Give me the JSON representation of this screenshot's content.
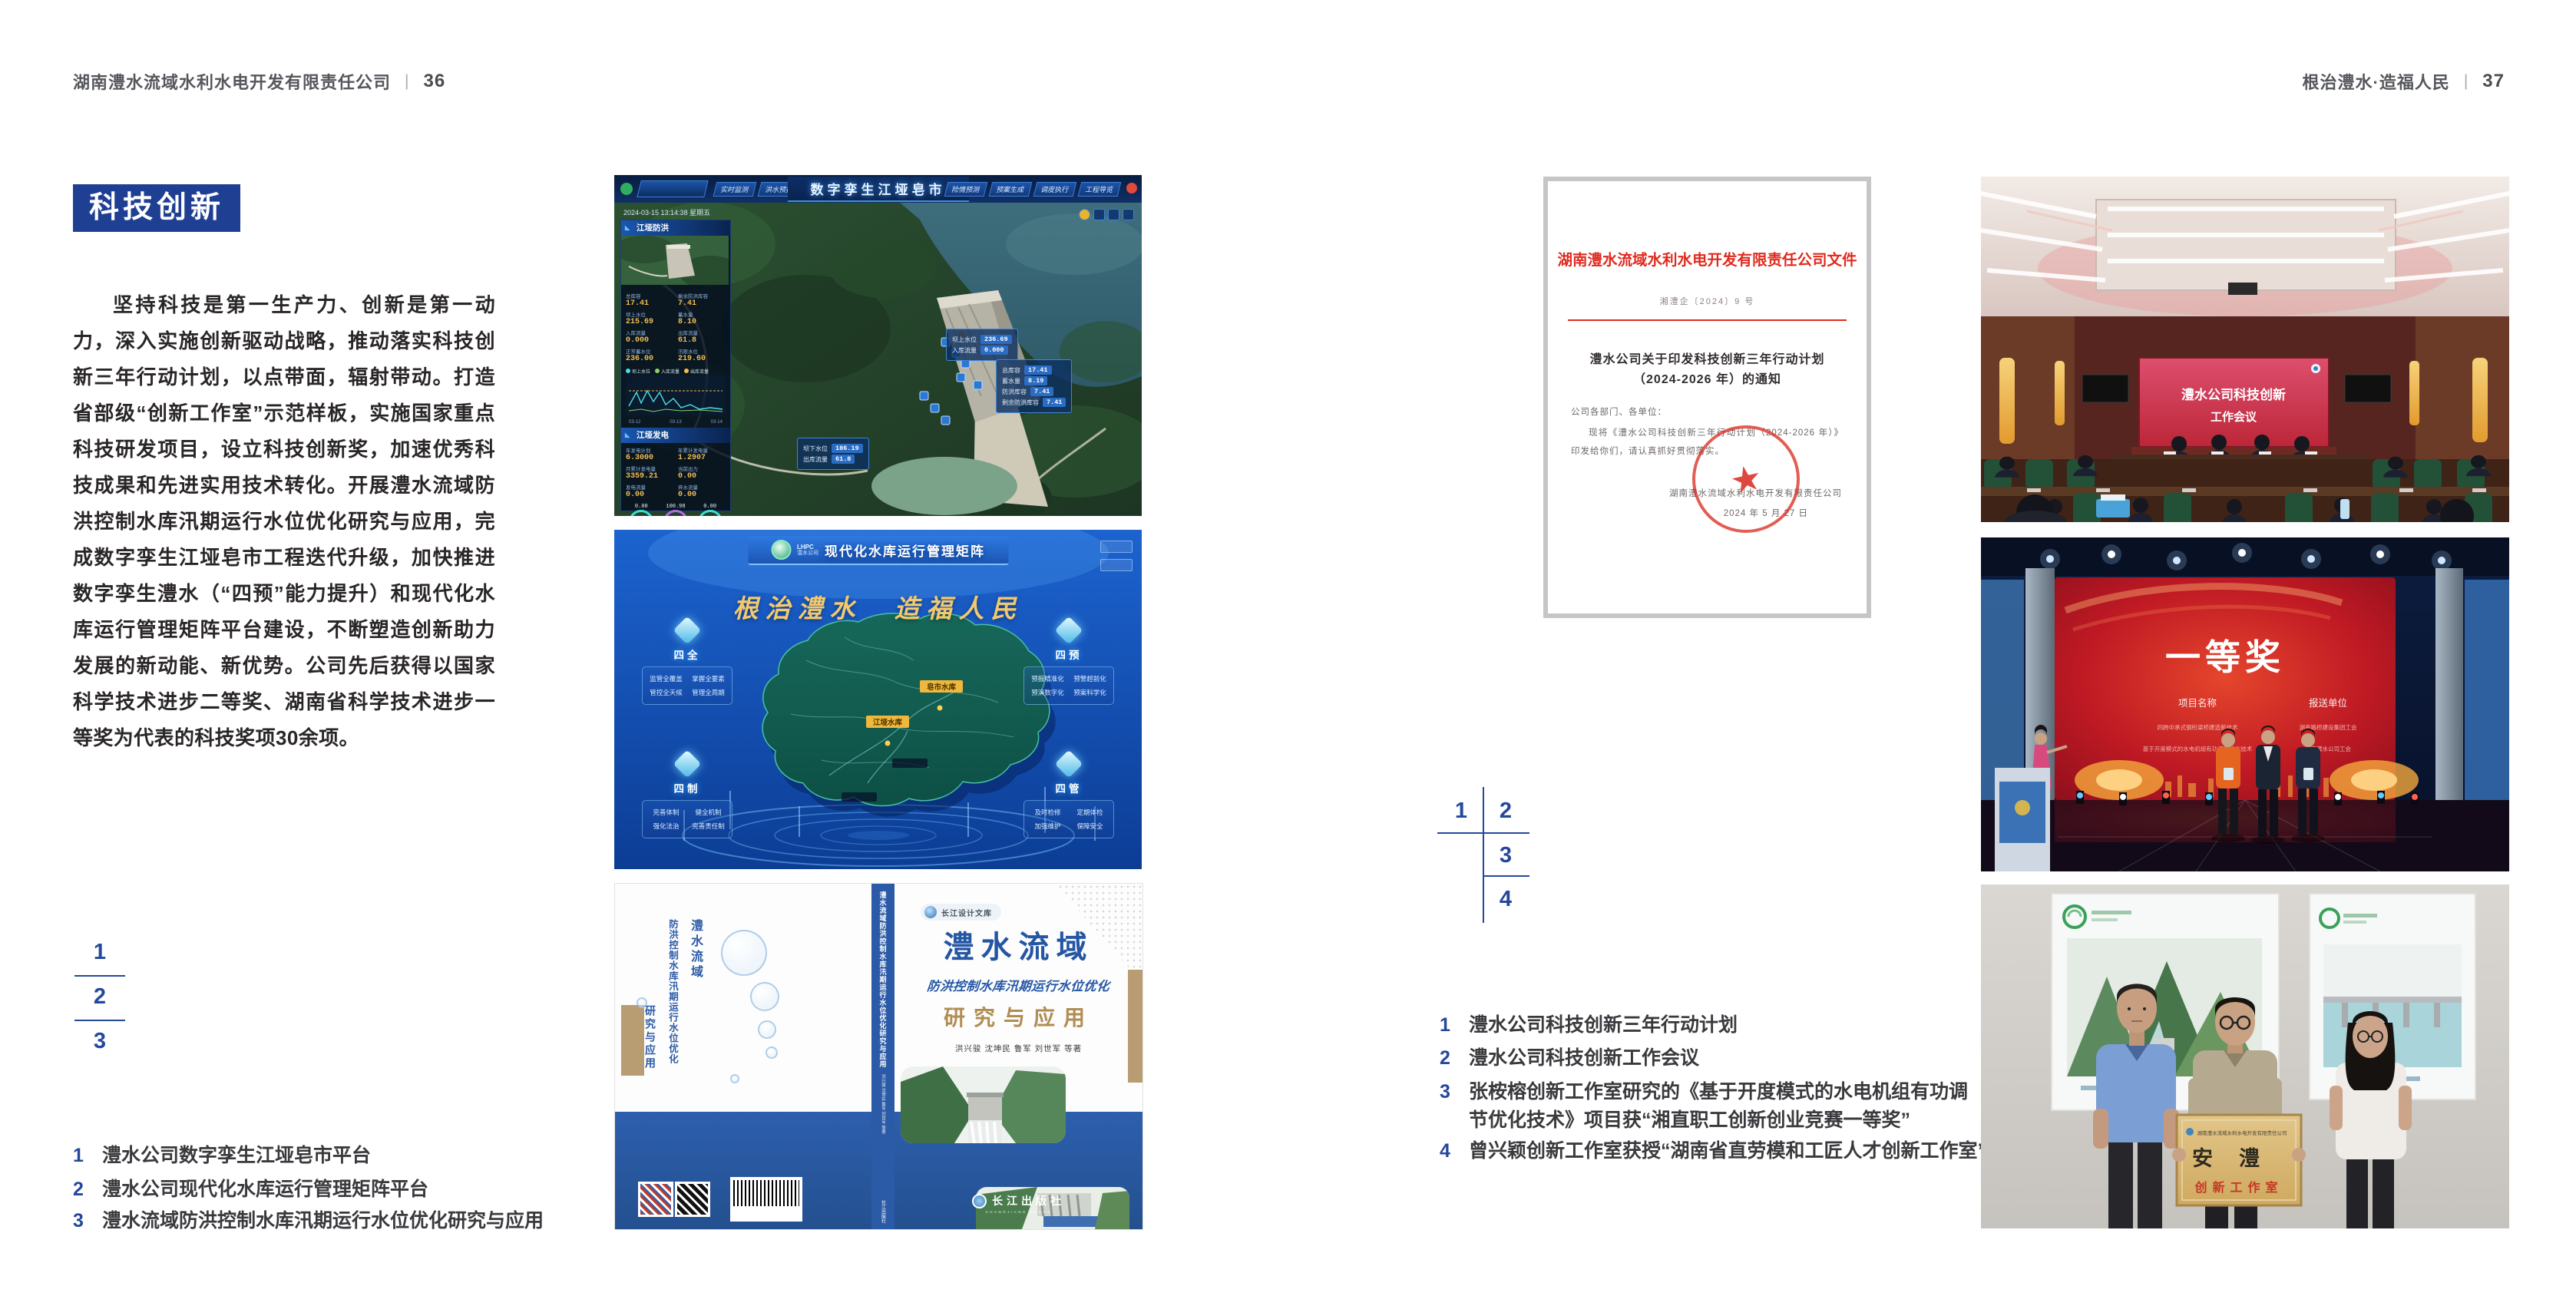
{
  "colors": {
    "accent_blue": "#1e3f92",
    "caption_blue": "#24489a",
    "text_dark": "#2a2628",
    "header_gray": "#55575c",
    "doc_red": "#d92d20",
    "book_blue": "#2b5aa7",
    "gold": "#b08d53"
  },
  "left_page": {
    "header_company": "湖南澧水流域水利水电开发有限责任公司",
    "header_sep": "|",
    "page_number": "36",
    "section_title": "科技创新",
    "paragraph": "坚持科技是第一生产力、创新是第一动力，深入实施创新驱动战略，推动落实科技创新三年行动计划，以点带面，辐射带动。打造省部级“创新工作室”示范样板，实施国家重点科技研发项目，设立科技创新奖，加速优秀科技成果和先进实用技术转化。开展澧水流域防洪控制水库汛期运行水位优化研究与应用，完成数字孪生江垭皂市工程迭代升级，加快推进数字孪生澧水（“四预”能力提升）和现代化水库运行管理矩阵平台建设，不断塑造创新助力发展的新动能、新优势。公司先后获得以国家科学技术进步二等奖、湖南省科学技术进步一等奖为代表的科技奖项30余项。",
    "figure_numbers": [
      "1",
      "2",
      "3"
    ],
    "captions": [
      {
        "num": "1",
        "text": "澧水公司数字孪生江垭皂市平台"
      },
      {
        "num": "2",
        "text": "澧水公司现代化水库运行管理矩阵平台"
      },
      {
        "num": "3",
        "text": "澧水流域防洪控制水库汛期运行水位优化研究与应用"
      }
    ]
  },
  "right_page": {
    "header_slogan": "根治澧水·造福人民",
    "header_sep": "|",
    "page_number": "37",
    "figure_numbers": [
      "1",
      "2",
      "3",
      "4"
    ],
    "captions": [
      {
        "num": "1",
        "text": "澧水公司科技创新三年行动计划"
      },
      {
        "num": "2",
        "text": "澧水公司科技创新工作会议"
      },
      {
        "num": "3",
        "text": "张桉榕创新工作室研究的《基于开度模式的水电机组有功调节优化技术》项目获“湘直职工创新创业竞赛一等奖”"
      },
      {
        "num": "4",
        "text": "曾兴颖创新工作室获授“湖南省直劳模和工匠人才创新工作室”"
      }
    ]
  },
  "fig_twin": {
    "title": "数字孪生江垭皂市",
    "datetime": "2024-03-15 13:14:38 星期五",
    "tabs_left": [
      "实时监测",
      "洪水预报",
      "防洪预警"
    ],
    "tabs_right": [
      "险情预测",
      "预案生成",
      "调度执行",
      "工程导览"
    ],
    "panel1_title": "江垭防洪",
    "panel2_title": "江垭发电",
    "stats1": [
      {
        "label": "总库容",
        "value": "17.41"
      },
      {
        "label": "剩余防洪库容",
        "value": "7.41"
      },
      {
        "label": "坝上水位",
        "value": "215.69"
      },
      {
        "label": "蓄水量",
        "value": "8.10"
      },
      {
        "label": "入库流量",
        "value": "0.000"
      },
      {
        "label": "出库流量",
        "value": "61.8"
      },
      {
        "label": "正常蓄水位",
        "value": "236.00"
      },
      {
        "label": "汛限水位",
        "value": "219.60"
      }
    ],
    "stats2": [
      {
        "label": "年发电计划",
        "value": "6.3000"
      },
      {
        "label": "年累计发电量",
        "value": "1.2907"
      },
      {
        "label": "月累计发电量",
        "value": "3359.21"
      },
      {
        "label": "当前出力",
        "value": "0.00"
      },
      {
        "label": "发电流量",
        "value": "0.00"
      },
      {
        "label": "弃水流量",
        "value": "0.00"
      }
    ],
    "gauge_values": [
      "0.00",
      "100.98",
      "0.00"
    ],
    "chart_legend": [
      "坝上水位",
      "入库流量",
      "出库流量"
    ],
    "chart_ticks": [
      "03-12",
      "03-13",
      "03-14"
    ],
    "box1": [
      {
        "label": "坝上水位",
        "value": "236.69"
      },
      {
        "label": "入库流量",
        "value": "0.000"
      }
    ],
    "box2": [
      {
        "label": "总库容",
        "value": "17.41"
      },
      {
        "label": "蓄水量",
        "value": "8.19"
      },
      {
        "label": "防洪库容",
        "value": "7.41"
      },
      {
        "label": "剩余防洪库容",
        "value": "7.41"
      }
    ],
    "box3": [
      {
        "label": "坝下水位",
        "value": "186.19"
      },
      {
        "label": "出库流量",
        "value": "61.8"
      }
    ]
  },
  "fig_matrix": {
    "logo_abbr": "LHPC",
    "logo_name": "澧水公司",
    "title": "现代化水库运行管理矩阵",
    "slogan": "根治澧水　造福人民",
    "panels": [
      {
        "title": "四全",
        "items": [
          "监管全覆盖",
          "掌握全要素",
          "管控全天候",
          "管理全周期"
        ]
      },
      {
        "title": "四预",
        "items": [
          "预报精准化",
          "预警超前化",
          "预演数字化",
          "预案科学化"
        ]
      },
      {
        "title": "四制",
        "items": [
          "完善体制",
          "健全机制",
          "强化法治",
          "完善责任制"
        ]
      },
      {
        "title": "四管",
        "items": [
          "及时检修",
          "定期体检",
          "加强维护",
          "保障安全"
        ]
      }
    ],
    "map_tags": [
      "皂市水库",
      "江垭水库"
    ]
  },
  "fig_book": {
    "series": "长江设计文库",
    "title_main": "澧水流域",
    "title_sub": "防洪控制水库汛期运行水位优化",
    "title_tail": "研究与应用",
    "authors": "洪兴骏 沈坤民 鲁军 刘世军 等著",
    "publisher": "长江出版社",
    "publisher_latin": "CHANGJIANG PRESS",
    "spine": "澧水流域防洪控制水库汛期运行水位优化研究与应用"
  },
  "fig_doc": {
    "header": "湖南澧水流域水利水电开发有限责任公司文件",
    "doc_no": "湘澧企〔2024〕9 号",
    "title1": "澧水公司关于印发科技创新三年行动计划",
    "title2": "（2024-2026 年）的通知",
    "salutation": "公司各部门、各单位：",
    "body": "现将《澧水公司科技创新三年行动计划（2024-2026 年）》印发给你们，请认真抓好贯彻落实。",
    "signer": "湖南澧水流域水利水电开发有限责任公司",
    "sign_date": "2024 年 5 月 27 日"
  },
  "fig_meeting": {
    "screen1": "澧水公司科技创新",
    "screen2": "工作会议"
  },
  "fig_award": {
    "title": "一等奖",
    "col1": "项目名称",
    "col2": "报送单位",
    "projects": [
      "四跨中承式钢桁梁桥建造新技术",
      "基于开度模式的水电机组有功调节优化技术"
    ],
    "units": [
      "湖南路桥建设集团工会",
      "湖南澧水公司工会"
    ]
  },
  "fig_workshop": {
    "plaque_company": "湖南澧水流域水利水电开发有限责任公司",
    "plaque_name": "安澧",
    "plaque_type": "创新工作室"
  }
}
